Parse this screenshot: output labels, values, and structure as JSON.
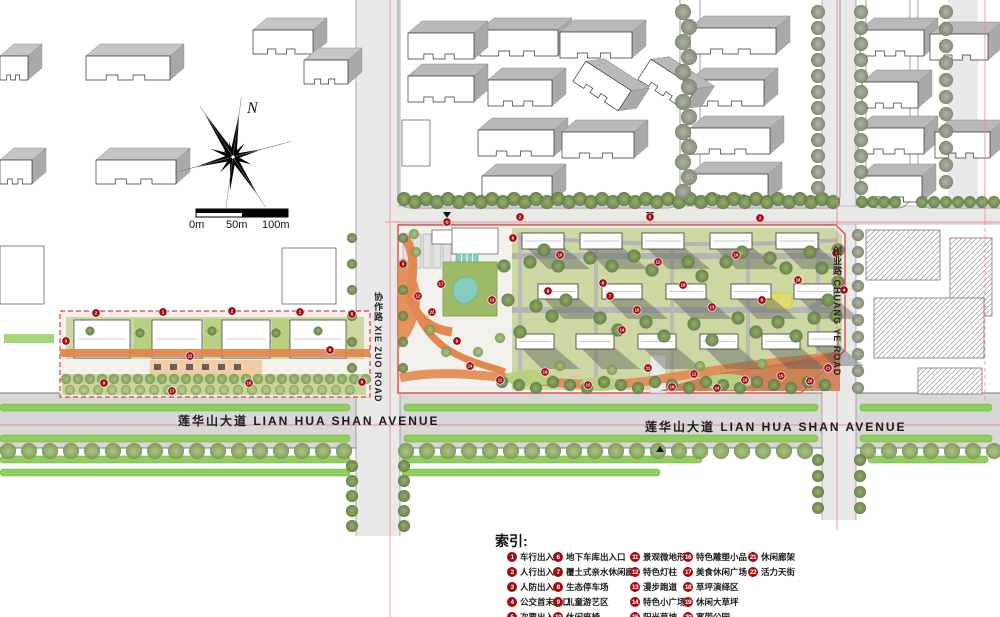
{
  "map": {
    "north_label": "N",
    "scale": {
      "labels": [
        "0m",
        "50m",
        "100m"
      ]
    },
    "roads": {
      "lianhuashan_left": "莲华山大道 LIAN HUA SHAN AVENUE",
      "lianhuashan_right": "莲华山大道 LIAN HUA SHAN AVENUE",
      "xiezuo": "协作路 XIE ZUO ROAD",
      "chuangye": "创业路 CHUANG YE ROAD"
    },
    "markers": [
      {
        "n": "2",
        "x": 96,
        "y": 313
      },
      {
        "n": "1",
        "x": 163,
        "y": 312
      },
      {
        "n": "2",
        "x": 232,
        "y": 311
      },
      {
        "n": "1",
        "x": 300,
        "y": 312
      },
      {
        "n": "5",
        "x": 352,
        "y": 314
      },
      {
        "n": "3",
        "x": 66,
        "y": 341
      },
      {
        "n": "9",
        "x": 104,
        "y": 383
      },
      {
        "n": "17",
        "x": 172,
        "y": 391
      },
      {
        "n": "22",
        "x": 190,
        "y": 356
      },
      {
        "n": "10",
        "x": 249,
        "y": 383
      },
      {
        "n": "6",
        "x": 330,
        "y": 350
      },
      {
        "n": "8",
        "x": 362,
        "y": 382
      },
      {
        "n": "1",
        "x": 447,
        "y": 222
      },
      {
        "n": "2",
        "x": 520,
        "y": 217
      },
      {
        "n": "5",
        "x": 650,
        "y": 217
      },
      {
        "n": "2",
        "x": 760,
        "y": 218
      },
      {
        "n": "3",
        "x": 403,
        "y": 264
      },
      {
        "n": "12",
        "x": 418,
        "y": 296
      },
      {
        "n": "17",
        "x": 441,
        "y": 284
      },
      {
        "n": "22",
        "x": 432,
        "y": 312
      },
      {
        "n": "9",
        "x": 457,
        "y": 341
      },
      {
        "n": "14",
        "x": 470,
        "y": 366
      },
      {
        "n": "13",
        "x": 492,
        "y": 300
      },
      {
        "n": "6",
        "x": 513,
        "y": 238
      },
      {
        "n": "10",
        "x": 560,
        "y": 255
      },
      {
        "n": "8",
        "x": 548,
        "y": 291
      },
      {
        "n": "8",
        "x": 603,
        "y": 283
      },
      {
        "n": "7",
        "x": 610,
        "y": 296
      },
      {
        "n": "12",
        "x": 658,
        "y": 262
      },
      {
        "n": "15",
        "x": 637,
        "y": 310
      },
      {
        "n": "14",
        "x": 622,
        "y": 330
      },
      {
        "n": "16",
        "x": 683,
        "y": 285
      },
      {
        "n": "13",
        "x": 712,
        "y": 307
      },
      {
        "n": "10",
        "x": 736,
        "y": 255
      },
      {
        "n": "6",
        "x": 762,
        "y": 300
      },
      {
        "n": "18",
        "x": 798,
        "y": 280
      },
      {
        "n": "1",
        "x": 836,
        "y": 253
      },
      {
        "n": "4",
        "x": 844,
        "y": 290
      },
      {
        "n": "11",
        "x": 500,
        "y": 380
      },
      {
        "n": "19",
        "x": 545,
        "y": 372
      },
      {
        "n": "15",
        "x": 588,
        "y": 385
      },
      {
        "n": "11",
        "x": 648,
        "y": 368
      },
      {
        "n": "19",
        "x": 672,
        "y": 387
      },
      {
        "n": "12",
        "x": 694,
        "y": 374
      },
      {
        "n": "14",
        "x": 717,
        "y": 388
      },
      {
        "n": "19",
        "x": 745,
        "y": 380
      },
      {
        "n": "15",
        "x": 781,
        "y": 376
      },
      {
        "n": "20",
        "x": 810,
        "y": 381
      },
      {
        "n": "21",
        "x": 828,
        "y": 368
      }
    ]
  },
  "legend": {
    "title": "索引:",
    "items": [
      {
        "n": "1",
        "label": "车行出入口"
      },
      {
        "n": "2",
        "label": "人行出入口"
      },
      {
        "n": "3",
        "label": "人防出入口"
      },
      {
        "n": "4",
        "label": "公交首末入口"
      },
      {
        "n": "5",
        "label": "次要出入口"
      },
      {
        "n": "6",
        "label": "地下车库出入口"
      },
      {
        "n": "7",
        "label": "覆土式亲水休闲廊"
      },
      {
        "n": "8",
        "label": "生态停车场"
      },
      {
        "n": "9",
        "label": "儿童游艺区"
      },
      {
        "n": "10",
        "label": "休闲座椅"
      },
      {
        "n": "11",
        "label": "景观微地形"
      },
      {
        "n": "12",
        "label": "特色灯柱"
      },
      {
        "n": "13",
        "label": "漫步跑道"
      },
      {
        "n": "14",
        "label": "特色小广场"
      },
      {
        "n": "15",
        "label": "阳光草坡"
      },
      {
        "n": "16",
        "label": "特色雕塑小品"
      },
      {
        "n": "17",
        "label": "美食休闲广场"
      },
      {
        "n": "18",
        "label": "草坪演绎区"
      },
      {
        "n": "19",
        "label": "休闲大草坪"
      },
      {
        "n": "20",
        "label": "宽带公园"
      },
      {
        "n": "21",
        "label": "休闲廊架"
      },
      {
        "n": "22",
        "label": "活力天街"
      }
    ]
  },
  "colors": {
    "badge": "#9e0b10",
    "boundary": "#e23c3c",
    "axis": "#f08080",
    "lawn": "#ccd7a2",
    "lawnBright": "#b9cf82",
    "plaza": "#f2f1ec",
    "path": "#e2874f",
    "pathDeep": "#cc6f45",
    "water": "#86cdbf",
    "median": "#8ccd57",
    "roadFill": "#e9e9e9",
    "avenueFill": "#d8d8d8",
    "slabRoof": "#b9b9b9",
    "shadow": "#53545a"
  }
}
